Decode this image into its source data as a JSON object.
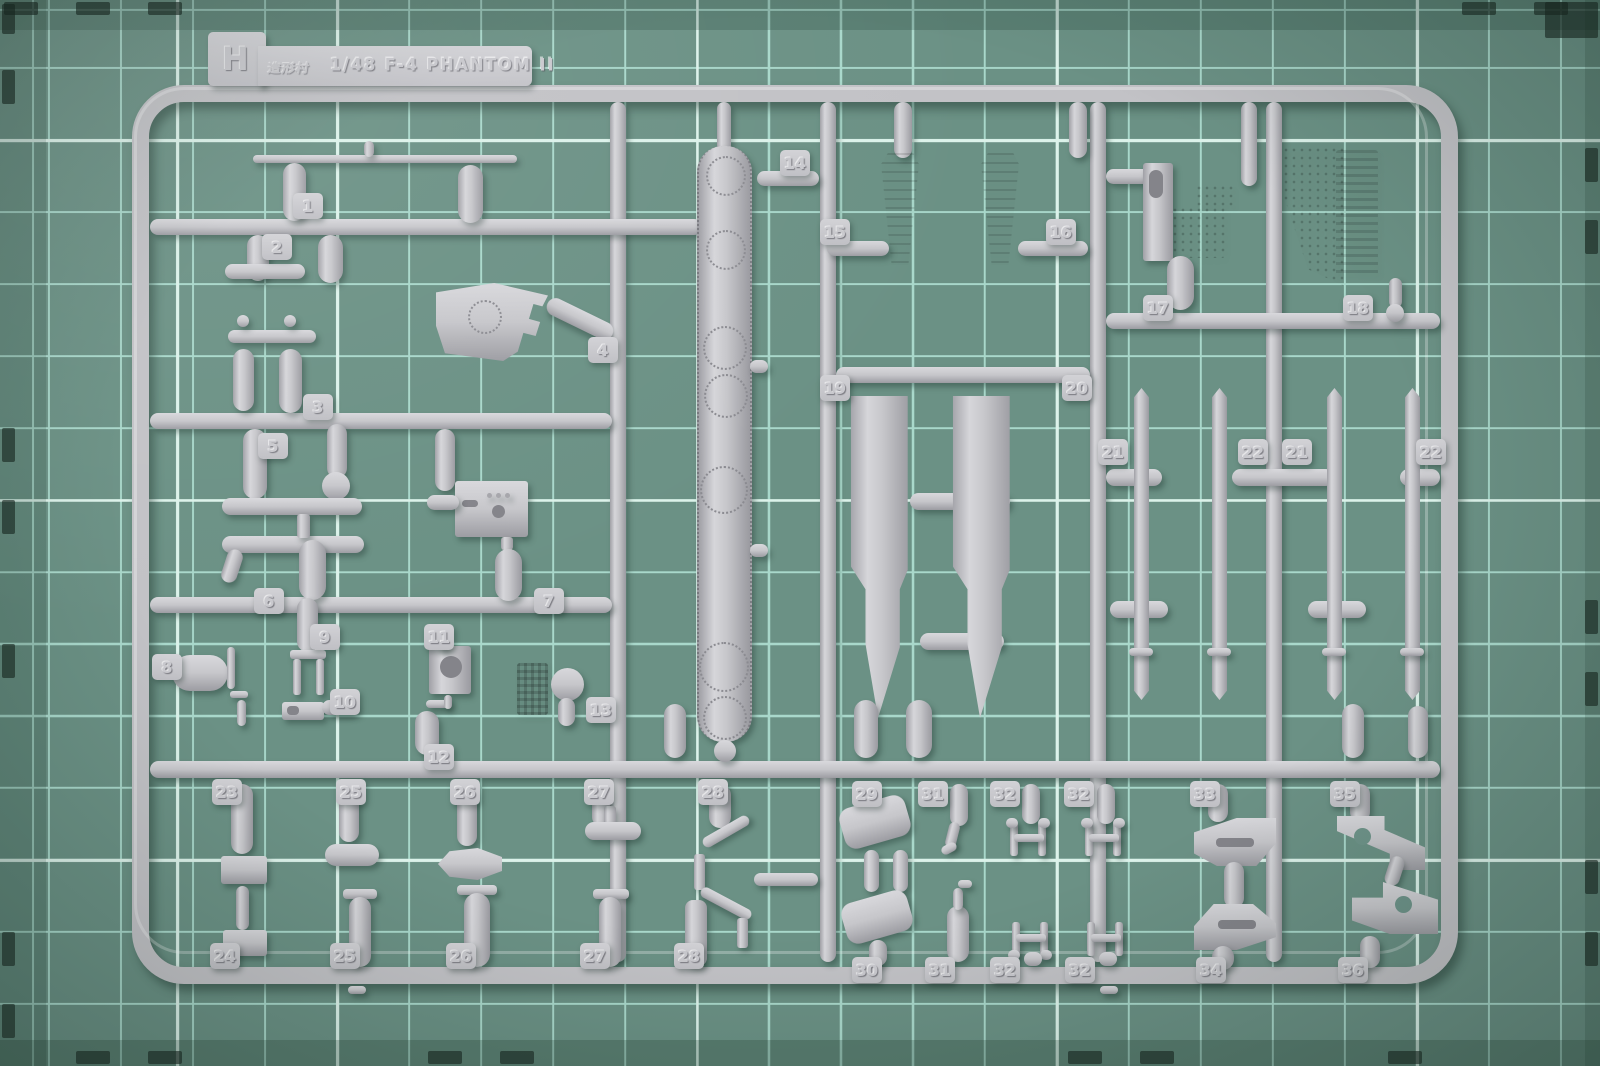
{
  "label": {
    "letter": "H",
    "brand_logo": "造形村",
    "title": "1/48 F-4 PHANTOM II"
  },
  "part_tags": [
    {
      "n": "1",
      "x": 293,
      "y": 193
    },
    {
      "n": "2",
      "x": 262,
      "y": 234
    },
    {
      "n": "3",
      "x": 303,
      "y": 394
    },
    {
      "n": "4",
      "x": 588,
      "y": 337
    },
    {
      "n": "5",
      "x": 258,
      "y": 433
    },
    {
      "n": "6",
      "x": 254,
      "y": 588
    },
    {
      "n": "7",
      "x": 534,
      "y": 588
    },
    {
      "n": "8",
      "x": 152,
      "y": 654
    },
    {
      "n": "9",
      "x": 310,
      "y": 624
    },
    {
      "n": "10",
      "x": 330,
      "y": 689
    },
    {
      "n": "11",
      "x": 424,
      "y": 624
    },
    {
      "n": "12",
      "x": 424,
      "y": 744
    },
    {
      "n": "13",
      "x": 586,
      "y": 697
    },
    {
      "n": "14",
      "x": 780,
      "y": 150
    },
    {
      "n": "15",
      "x": 820,
      "y": 219
    },
    {
      "n": "16",
      "x": 1046,
      "y": 219
    },
    {
      "n": "17",
      "x": 1143,
      "y": 295
    },
    {
      "n": "18",
      "x": 1343,
      "y": 295
    },
    {
      "n": "19",
      "x": 820,
      "y": 375
    },
    {
      "n": "20",
      "x": 1062,
      "y": 375
    },
    {
      "n": "21",
      "x": 1098,
      "y": 439
    },
    {
      "n": "22",
      "x": 1238,
      "y": 439
    },
    {
      "n": "21",
      "x": 1282,
      "y": 439
    },
    {
      "n": "22",
      "x": 1416,
      "y": 439
    },
    {
      "n": "23",
      "x": 212,
      "y": 779
    },
    {
      "n": "25",
      "x": 336,
      "y": 779
    },
    {
      "n": "26",
      "x": 450,
      "y": 779
    },
    {
      "n": "27",
      "x": 584,
      "y": 779
    },
    {
      "n": "28",
      "x": 698,
      "y": 779
    },
    {
      "n": "29",
      "x": 852,
      "y": 781
    },
    {
      "n": "31",
      "x": 918,
      "y": 781
    },
    {
      "n": "32",
      "x": 990,
      "y": 781
    },
    {
      "n": "32",
      "x": 1064,
      "y": 781
    },
    {
      "n": "33",
      "x": 1190,
      "y": 781
    },
    {
      "n": "35",
      "x": 1330,
      "y": 781
    },
    {
      "n": "24",
      "x": 210,
      "y": 943
    },
    {
      "n": "25",
      "x": 330,
      "y": 943
    },
    {
      "n": "26",
      "x": 446,
      "y": 943
    },
    {
      "n": "27",
      "x": 580,
      "y": 943
    },
    {
      "n": "28",
      "x": 674,
      "y": 943
    },
    {
      "n": "30",
      "x": 852,
      "y": 957
    },
    {
      "n": "31",
      "x": 925,
      "y": 957
    },
    {
      "n": "32",
      "x": 990,
      "y": 957
    },
    {
      "n": "32",
      "x": 1065,
      "y": 957
    },
    {
      "n": "34",
      "x": 1196,
      "y": 957
    },
    {
      "n": "36",
      "x": 1338,
      "y": 957
    }
  ],
  "colors": {
    "mat_green": "#6b9185",
    "grid_line": "#a9d8cb",
    "grid_accent": "#dcf2ea",
    "plastic_grey": "#c6c6ca",
    "plastic_shadow": "#9a9aa0",
    "mat_edge_mark": "#16251e"
  }
}
